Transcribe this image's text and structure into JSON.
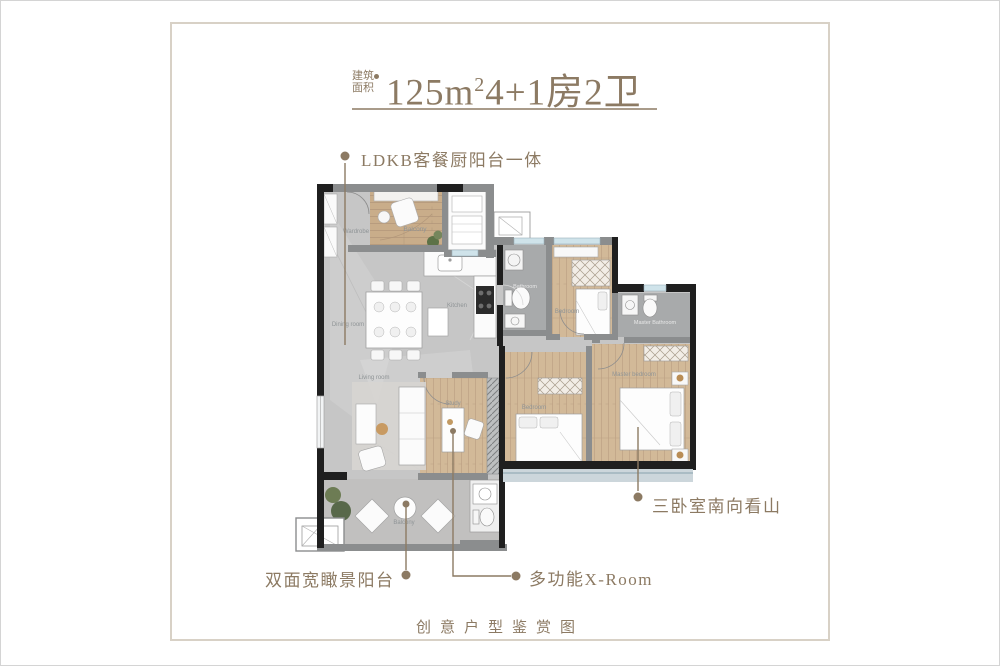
{
  "header": {
    "area_label_line1": "建筑",
    "area_label_line2": "面积",
    "title_main": "125m",
    "title_sup": "2",
    "title_rest": "4+1房2卫"
  },
  "annotations": {
    "ldkb": "LDKB客餐厨阳台一体",
    "south_view": "三卧室南向看山",
    "wide_balcony": "双面宽瞰景阳台",
    "xroom": "多功能X-Room"
  },
  "caption": "创意户型鉴赏图",
  "floorplan": {
    "labels": {
      "wardrobe": "Wardrobe",
      "balcony_north": "Balcony",
      "kitchen": "Kitchen",
      "bathroom": "Bathroom",
      "bedroom_north": "Bedroom",
      "master_bathroom": "Master Bathroom",
      "dining": "Dining room",
      "living": "Living room",
      "study": "Study",
      "bedroom_south": "Bedroom",
      "master_bedroom": "Master bedroom",
      "balcony_south": "Balcony"
    }
  },
  "colors": {
    "accent_brown": "#8c7a63",
    "wall_black": "#1f1f1f",
    "wall_gray": "#8b8d8e",
    "wood_floor": "#cbb190",
    "stone_floor": "#c6c6c6",
    "window_blue": "#cfe3ea",
    "frame_border": "#d8d1c6"
  }
}
